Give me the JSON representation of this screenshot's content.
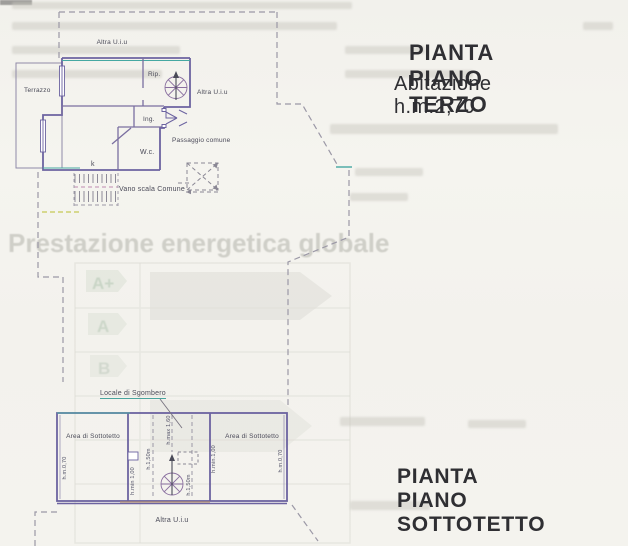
{
  "titles": {
    "terzo_title": "PIANTA PIANO TERZO",
    "terzo_subtitle": "Abitazione h.m.2,70",
    "sottotetto_title": "PIANTA PIANO SOTTOTETTO"
  },
  "plan_terzo": {
    "labels": {
      "altra_uiu_top": "Altra U.i.u",
      "terrazzo": "Terrazzo",
      "rip": "Rip.",
      "altra_uiu_right": "Altra U.i.u",
      "ing": "Ing.",
      "passaggio_comune": "Passaggio comune",
      "wc": "W.c.",
      "k": "k",
      "vano_scala": "Vano scala Comune"
    }
  },
  "plan_sottotetto": {
    "labels": {
      "locale_sgombero": "Locale di Sgombero",
      "area_sottotetto_sx": "Area di Sottotetto",
      "area_sottotetto_dx": "Area di Sottotetto",
      "h_left_wall": "h.m.0,70",
      "h_min_left": "h.min 1,00",
      "h_150_left": "h.1,50m",
      "h_max_center": "h.max 1,60",
      "h_150_right": "h.1,50m",
      "h_min_right": "h.min.1,00",
      "h_right_wall": "h.m.0,70",
      "altra_uiu_bottom": "Altra U.i.u"
    }
  },
  "ghost_text": {
    "energy_title": "Prestazione energetica globale",
    "class_a_plus": "A+",
    "class_a": "A",
    "class_b": "B"
  },
  "colors": {
    "paper": "#f4f3ee",
    "wall_purple": "#6c63a0",
    "wall_teal": "#45a8a2",
    "accent_magenta": "#b07ab0",
    "accent_orange": "#c49a6a",
    "dash_gray": "#9b98a6",
    "dash_yellow": "#cdd06e",
    "title_ink": "#2f2f33"
  }
}
